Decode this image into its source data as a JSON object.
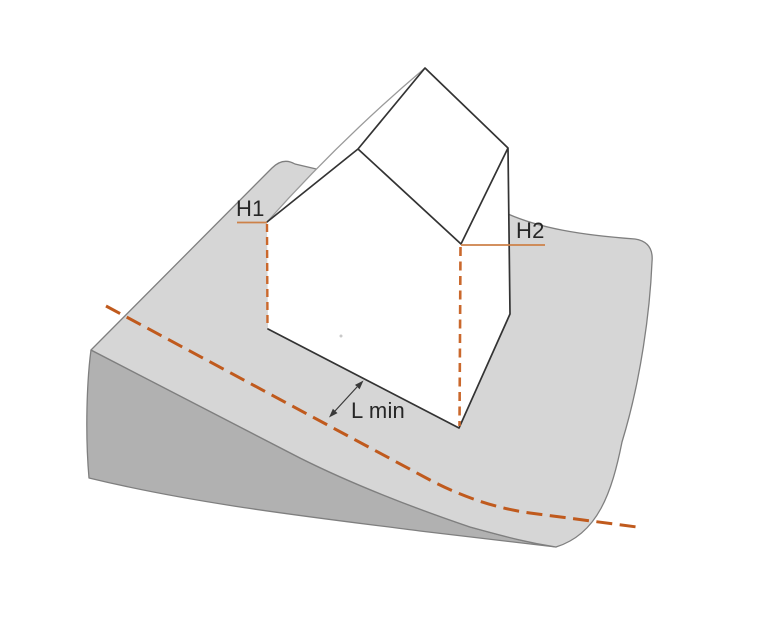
{
  "figure": {
    "kind": "technical-illustration",
    "description": "House on a sloped terrain wedge with height annotations H1 and H2 and a minimum setback distance L min to a dashed boundary line",
    "labels": {
      "height_left": "H1",
      "height_right": "H2",
      "min_distance": "L min"
    },
    "colors": {
      "background": "#ffffff",
      "terrain_top": "#d6d6d6",
      "terrain_side": "#b1b1b1",
      "terrain_outline": "#7f7f7f",
      "house_fill": "#ffffff",
      "house_edge": "#333333",
      "house_edge_light": "#9a9a9a",
      "tick_line": "#cd8148",
      "height_dash_line": "#ca682c",
      "setback_dash_line": "#c05a1d",
      "label_text": "#262626",
      "arrow": "#3a3a3a",
      "speck": "#c9c9c9"
    }
  }
}
